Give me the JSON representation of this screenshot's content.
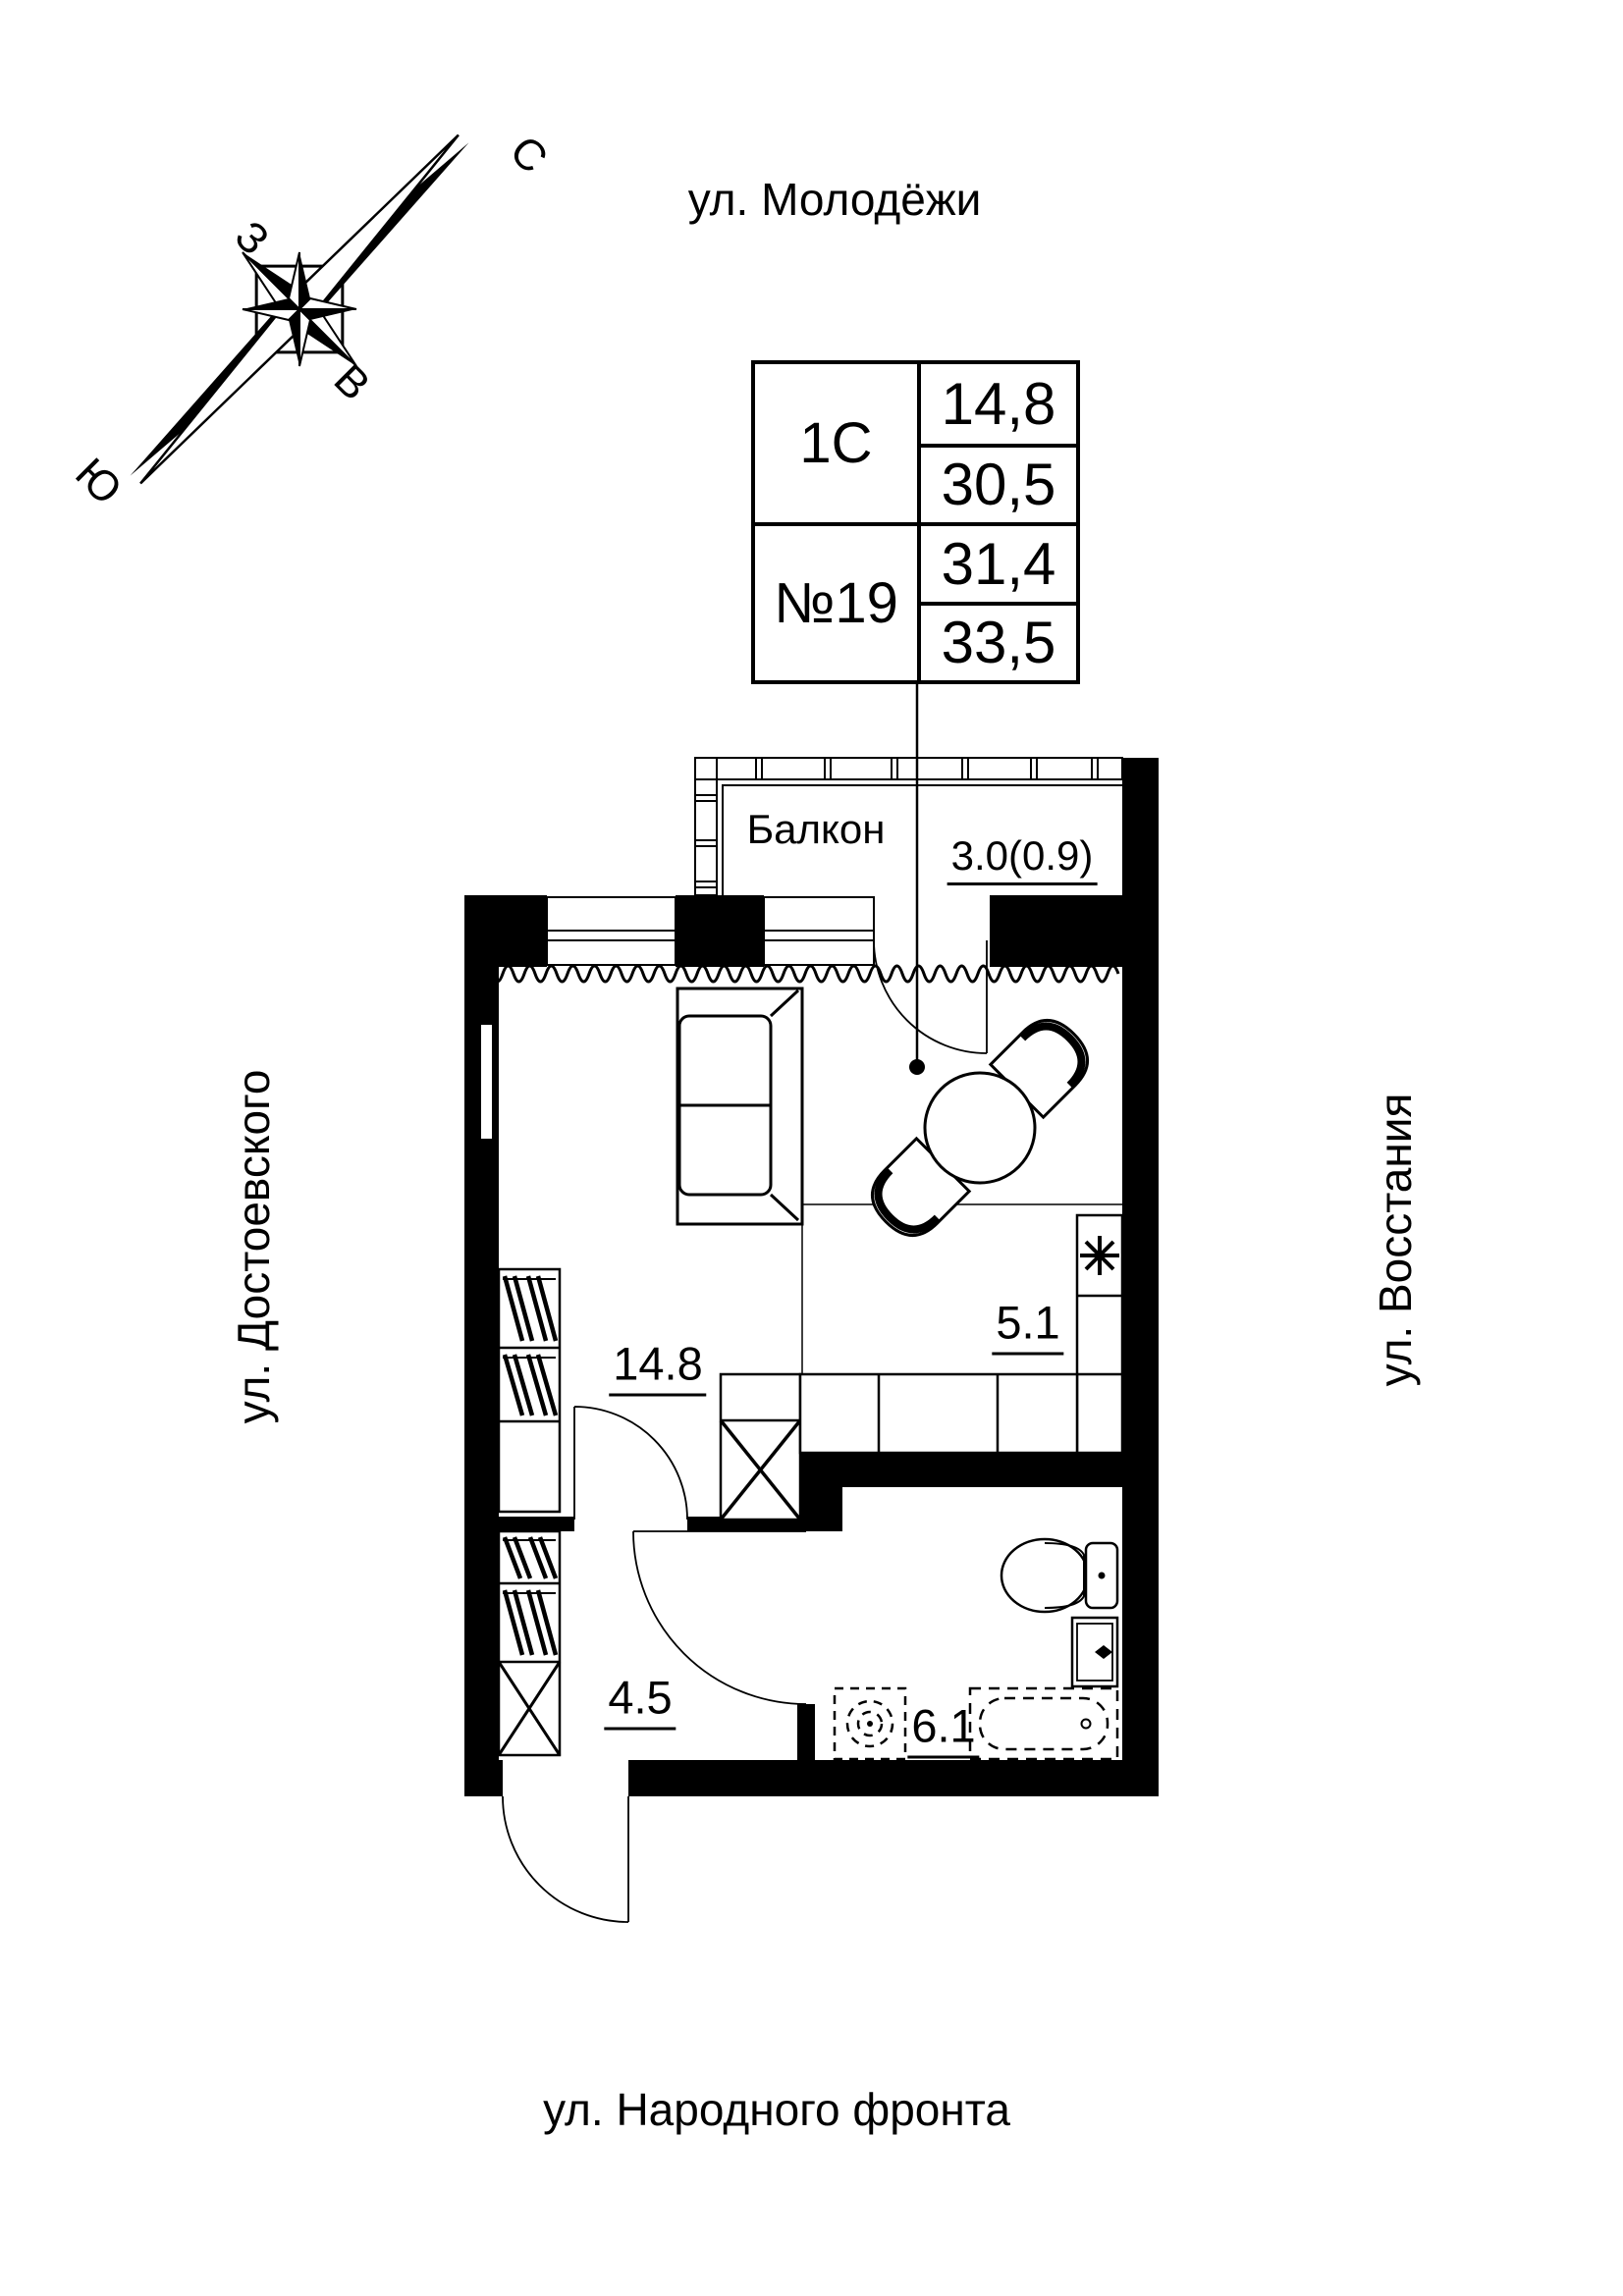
{
  "streets": {
    "top": "ул. Молодёжи",
    "bottom": "ул. Народного фронта",
    "left": "ул. Достоевского",
    "right": "ул. Восстания"
  },
  "compass": {
    "north": "С",
    "south": "Ю",
    "west": "З",
    "east": "В"
  },
  "unit": {
    "type": "1С",
    "number": "№19",
    "areas": [
      "14,8",
      "30,5",
      "31,4",
      "33,5"
    ]
  },
  "rooms": {
    "balcony": {
      "name": "Балкон",
      "area": "3.0(0.9)"
    },
    "living": {
      "area": "14.8"
    },
    "kitchen_zone": {
      "area": "5.1"
    },
    "hallway": {
      "area": "4.5"
    },
    "bathroom": {
      "area": "6.1"
    }
  },
  "icons": {
    "stove": "burner-asterisk",
    "compass": "compass-rose",
    "leader": "unit-pointer-dot"
  },
  "colors": {
    "ink": "#000000",
    "paper": "#ffffff"
  }
}
